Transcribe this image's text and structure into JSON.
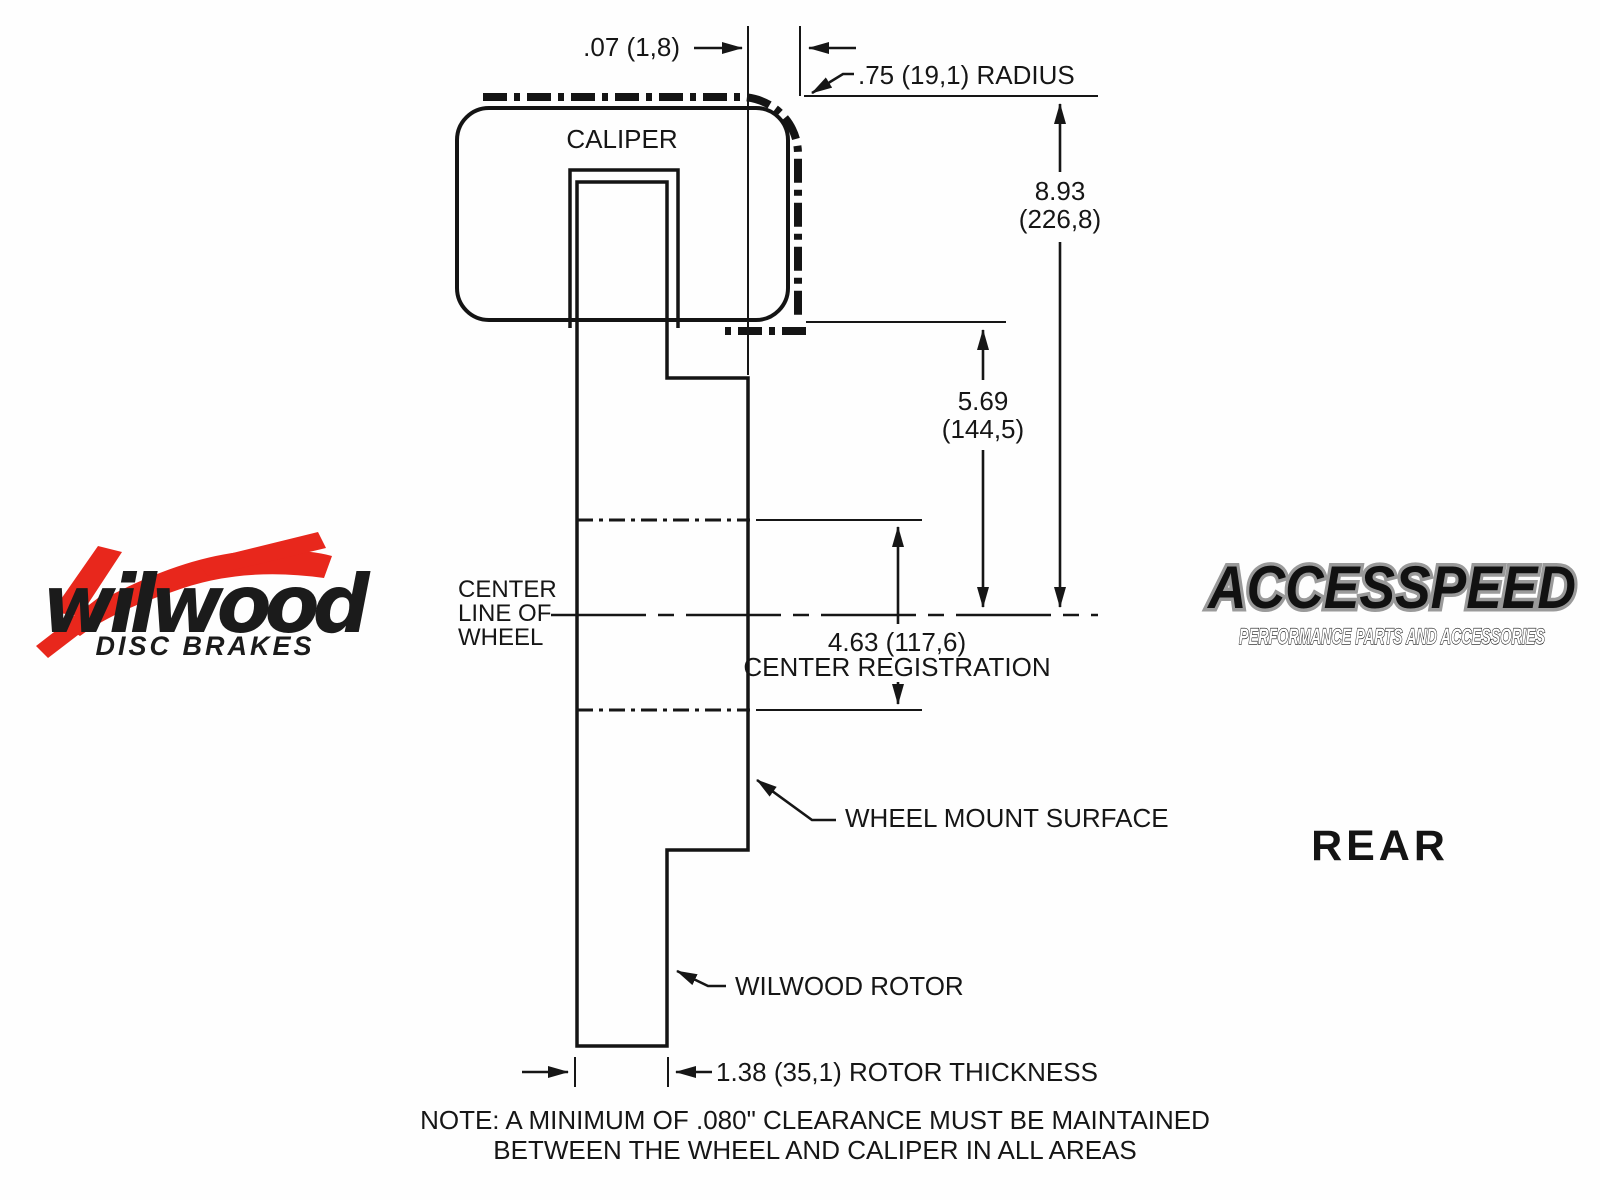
{
  "diagram": {
    "caliper_label": "CALIPER",
    "offset_dim": ".07 (1,8)",
    "radius_label": ".75 (19,1) RADIUS",
    "overall_height": {
      "inches": "8.93",
      "mm": "(226,8)"
    },
    "caliper_height": {
      "inches": "5.69",
      "mm": "(144,5)"
    },
    "centerline_label": [
      "CENTER",
      "LINE OF",
      "WHEEL"
    ],
    "center_registration": {
      "value": "4.63 (117,6)",
      "label": "CENTER REGISTRATION"
    },
    "wheel_mount_label": "WHEEL MOUNT SURFACE",
    "rotor_label": "WILWOOD ROTOR",
    "rotor_thickness": "1.38 (35,1) ROTOR THICKNESS",
    "note_line1": "NOTE: A MINIMUM OF .080\" CLEARANCE MUST BE MAINTAINED",
    "note_line2": "BETWEEN THE WHEEL AND CALIPER IN ALL AREAS"
  },
  "branding": {
    "wilwood": {
      "name": "wilwood",
      "tagline": "DISC BRAKES"
    },
    "accesspeed": {
      "name": "ACCESSPEED",
      "tagline": "PERFORMANCE PARTS AND ACCESSORIES"
    },
    "position_label": "REAR"
  },
  "colors": {
    "line": "#161616",
    "caliper_fill": "#ebebeb",
    "rotor_fill": "#c9c9cd",
    "wilwood_red": "#e8271c"
  }
}
